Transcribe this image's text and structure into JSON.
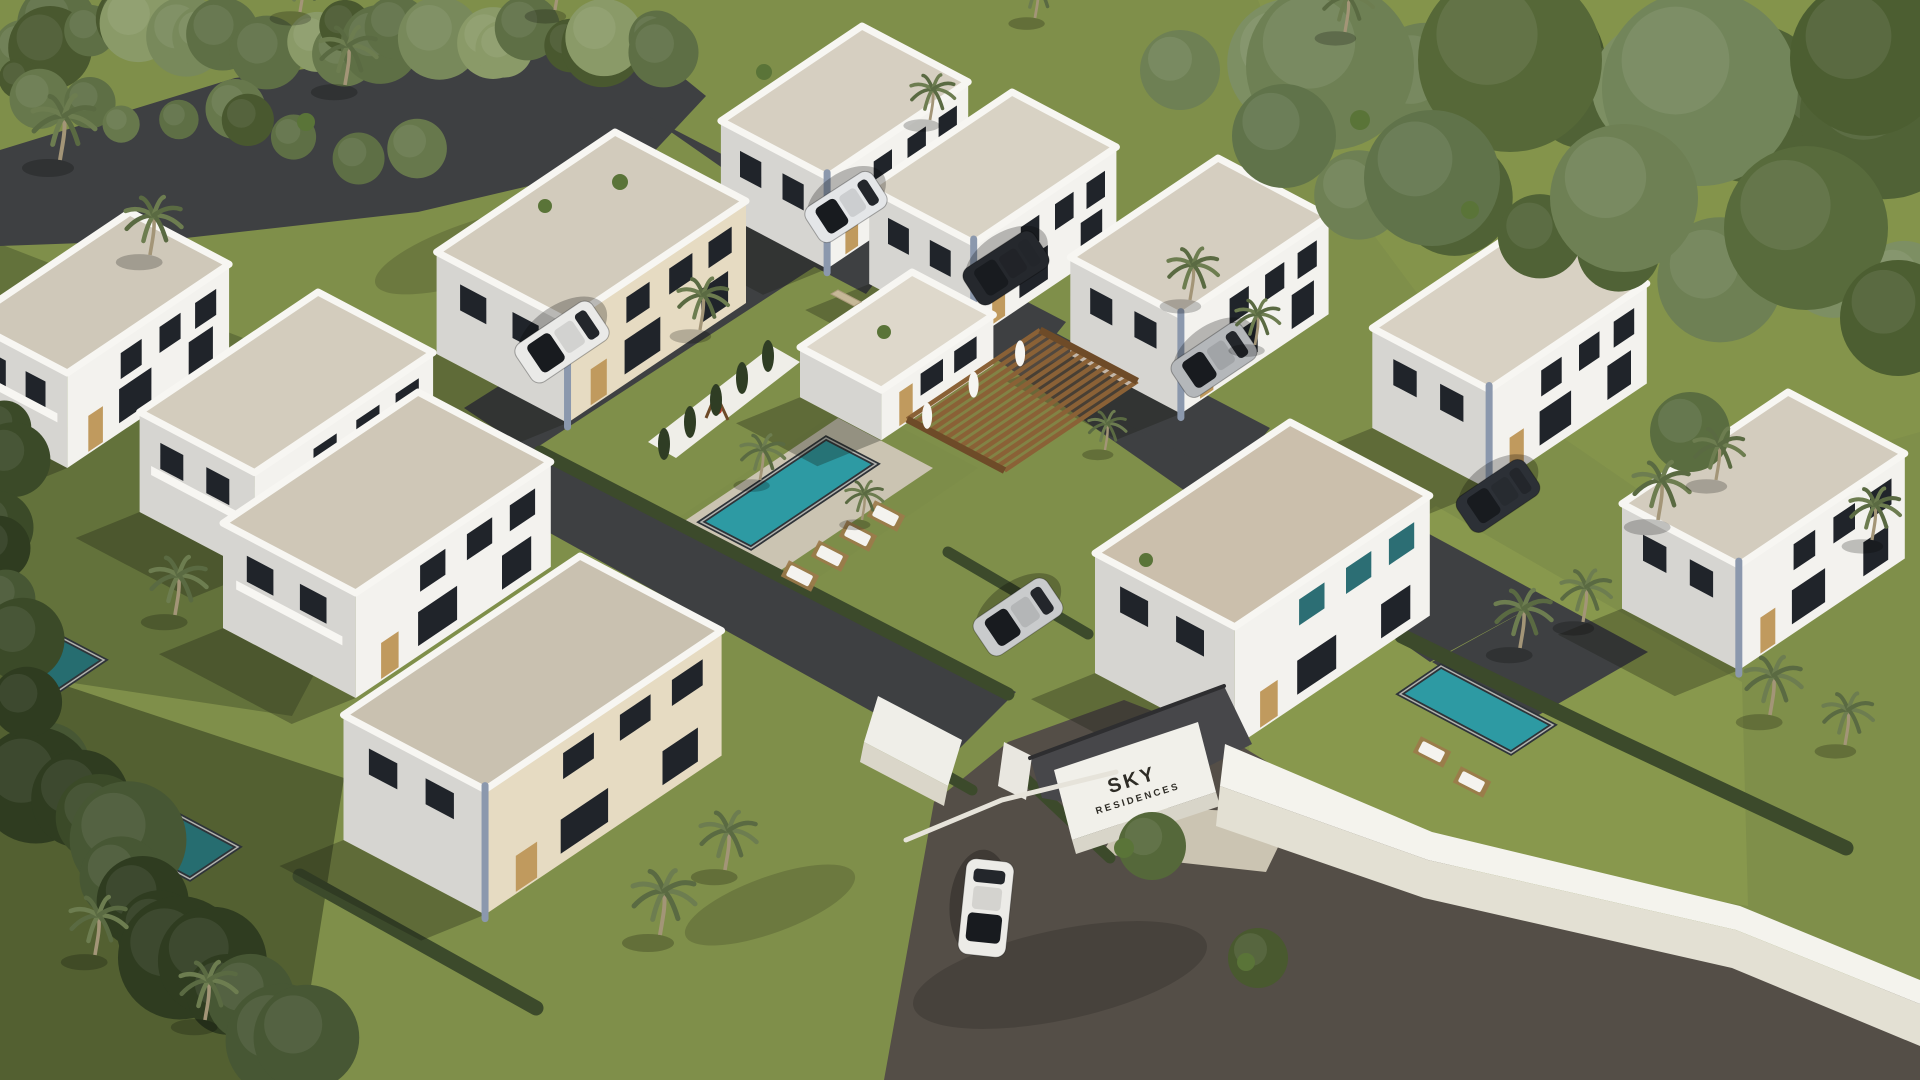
{
  "scene": {
    "title": "Aerial 3D architectural rendering of a gated residential villa community with pools and palm trees",
    "sign": {
      "line1": "SKY",
      "line2": "RESIDENCES"
    },
    "palette": {
      "grass": "#7f8f4a",
      "road": "#3e4042",
      "roadWarm": "#544e47",
      "paver": "#cbc4b2",
      "parapet": "#f7f6f2",
      "wallLit": "#f3f2ee",
      "wallShade": "#d6d5d1",
      "wallBeige": "#e6dbc2",
      "accent": "#8b98ad",
      "window": "#20242a",
      "glass": "#2c6e74",
      "door": "#c09a5e",
      "pool": "#2d9aa3",
      "poolShade": "#266d70",
      "poolEdge": "#2e3338",
      "coping": "#e9e7df",
      "hedge": "#3c4a2b",
      "cypress": "#2f3d24",
      "wood": "#8a6136",
      "woodDark": "#6e4b28",
      "wallWhite": "#efeee8",
      "shadow": "rgba(22,26,16,0.30)",
      "carShadow": "rgba(0,0,0,0.25)",
      "palmFrond": "#6d7d50",
      "palmFrondDark": "#59694271",
      "palmTrunk": "#a39577",
      "lounger": "#f4f3ef",
      "deckWood": "#9c7a4a",
      "canopy": "#47474a",
      "signText": "#2e2c26",
      "stone": "#c6b897"
    },
    "axes": {
      "u": [
        0.885,
        0.466
      ],
      "v": [
        -0.83,
        0.558
      ]
    },
    "ground": {
      "base": "#7f8f4a",
      "polys": [
        {
          "name": "grass-shade-left",
          "points": "0,244 450,418 292,716 0,672",
          "fill": "rgba(30,40,22,0.28)"
        },
        {
          "name": "grass-shade-bottom-left",
          "points": "0,664 344,778 296,1080 0,1080",
          "fill": "rgba(18,26,12,0.40)"
        },
        {
          "name": "grass-sun-villa-j-yard",
          "points": "1236,636 1436,506 1742,682 1748,906 1434,852 1252,772",
          "fill": "rgba(148,163,83,0.45)"
        },
        {
          "name": "grass-sun-top-right",
          "points": "1258,0 1920,0 1920,432 1662,506 1546,426 1422,300 1312,152",
          "fill": "rgba(140,156,78,0.40)"
        },
        {
          "name": "pool-island-lawn",
          "points": "852,402 978,468 800,590 672,522",
          "fill": "#7d8d49"
        },
        {
          "name": "road-top",
          "points": "0,150 235,78 500,44 652,52 706,96 648,158 418,212 168,240 0,246",
          "fill": "road"
        },
        {
          "name": "street-northeast",
          "points": "648,116 772,180 1548,598 1430,662",
          "fill": "road"
        },
        {
          "name": "street-northwest",
          "points": "800,196 868,232 530,452 464,408",
          "fill": "road"
        },
        {
          "name": "street-southwest",
          "points": "520,436 1016,692 952,756 458,482",
          "fill": "road"
        },
        {
          "name": "driveway-a",
          "points": "762,164 908,240 866,294 722,218",
          "fill": "road"
        },
        {
          "name": "driveway-b",
          "points": "920,246 1066,322 1024,374 880,298",
          "fill": "road"
        },
        {
          "name": "driveway-c",
          "points": "1128,354 1270,428 1230,478 1088,404",
          "fill": "road"
        },
        {
          "name": "street-east-end",
          "points": "1432,662 1548,598 1648,652 1530,720",
          "fill": "road"
        },
        {
          "name": "road-bottom-lot",
          "points": "884,1080 934,802 1008,742 1124,700 1238,744 1424,858 1704,932 1920,1000 1920,1080",
          "fill": "roadWarm"
        },
        {
          "name": "pool-deck",
          "points": "838,418 933,468 775,574 680,524",
          "fill": "paver"
        },
        {
          "name": "walkway-entrance",
          "points": "1130,806 1294,814 1266,872 1102,854",
          "fill": "paver"
        },
        {
          "name": "pool-privacy-wall",
          "points": "772,346 800,362 676,458 648,442",
          "fill": "wallWhite"
        }
      ]
    },
    "strokes": [
      {
        "name": "hedge-pool-island",
        "points": "540,452 1008,694",
        "stroke": "hedge",
        "width": 13
      },
      {
        "name": "hedge-villa-j",
        "points": "948,552 1088,634",
        "stroke": "hedge",
        "width": 11
      },
      {
        "name": "hedge-east-pool",
        "points": "1402,636 1612,738 1846,848",
        "stroke": "hedge",
        "width": 15
      },
      {
        "name": "hedge-entry-street",
        "points": "1010,764 1110,858",
        "stroke": "hedge",
        "width": 11
      },
      {
        "name": "hedge-foreground",
        "points": "300,876 536,1008",
        "stroke": "hedge",
        "width": 15
      },
      {
        "name": "hedge-gate-left",
        "points": "884,740 972,790",
        "stroke": "hedge",
        "width": 11
      }
    ],
    "roadShadows": [
      {
        "x": 1060,
        "y": 975,
        "rx": 150,
        "ry": 45,
        "rot": -12
      },
      {
        "x": 770,
        "y": 905,
        "rx": 90,
        "ry": 28,
        "rot": -20
      },
      {
        "x": 480,
        "y": 250,
        "rx": 110,
        "ry": 30,
        "rot": -18
      }
    ],
    "pools": [
      {
        "name": "community-pool",
        "points": "826,438 876,464 751,548 701,522",
        "fill": "pool"
      },
      {
        "name": "villa-pool-east",
        "points": "1441,666 1553,725 1511,753 1400,694",
        "fill": "pool"
      },
      {
        "name": "villa-pool-west-1",
        "points": "20,616 104,660 58,691 -26,647",
        "fill": "poolShade"
      },
      {
        "name": "villa-pool-west-2",
        "points": "150,800 238,847 190,879 102,832",
        "fill": "poolShade"
      }
    ],
    "houses": [
      {
        "name": "villa-a",
        "px": 862,
        "py": 26,
        "w": 120,
        "d": 170,
        "h": 92,
        "roof": "#d6cfc1",
        "acc": true
      },
      {
        "name": "villa-b",
        "px": 1012,
        "py": 92,
        "w": 118,
        "d": 172,
        "h": 96,
        "roof": "#d8d2c4",
        "acc": true
      },
      {
        "name": "villa-f",
        "px": 615,
        "py": 132,
        "w": 148,
        "d": 215,
        "h": 102,
        "roof": "#d2cbbc",
        "acc": true,
        "beigeR": true
      },
      {
        "name": "villa-c",
        "px": 1218,
        "py": 158,
        "w": 125,
        "d": 178,
        "h": 98,
        "roof": "#d5cec0",
        "acc": true
      },
      {
        "name": "villa-g",
        "px": 130,
        "py": 212,
        "w": 112,
        "d": 195,
        "h": 95,
        "roof": "#cfc8b9",
        "bal": true
      },
      {
        "name": "villa-d",
        "px": 1530,
        "py": 222,
        "w": 132,
        "d": 190,
        "h": 100,
        "roof": "#d8d1c3",
        "acc": true
      },
      {
        "name": "clubhouse",
        "px": 912,
        "py": 272,
        "w": 92,
        "d": 135,
        "h": 50,
        "roof": "#ded8cb",
        "club": true
      },
      {
        "name": "villa-h",
        "px": 318,
        "py": 292,
        "w": 130,
        "d": 215,
        "h": 100,
        "roof": "#d3ccbd",
        "bal": true
      },
      {
        "name": "villa-e",
        "px": 1788,
        "py": 392,
        "w": 132,
        "d": 200,
        "h": 105,
        "roof": "#d3ccbe",
        "acc": true
      },
      {
        "name": "villa-i1",
        "px": 418,
        "py": 392,
        "w": 150,
        "d": 235,
        "h": 105,
        "roof": "#cfc7b7",
        "bal": true
      },
      {
        "name": "villa-j",
        "px": 1290,
        "py": 422,
        "w": 158,
        "d": 235,
        "h": 120,
        "roof": "#cbbfac",
        "glass": true
      },
      {
        "name": "villa-i2",
        "px": 580,
        "py": 556,
        "w": 160,
        "d": 285,
        "h": 125,
        "roof": "#c9c1b0",
        "acc": true,
        "beigeR": true
      }
    ],
    "windowSpec": {
      "upperY": 16,
      "upperH": 26,
      "lowerH": 34,
      "rowsR": [
        [
          0.08,
          0.13
        ],
        [
          0.3,
          0.13
        ],
        [
          0.54,
          0.13
        ]
      ],
      "lowerR": [
        [
          0.1,
          0.15
        ],
        [
          0.48,
          0.2
        ]
      ],
      "door": [
        0.78,
        0.09
      ],
      "rowsL": [
        [
          0.18,
          0.2
        ],
        [
          0.58,
          0.2
        ]
      ]
    },
    "pergola": {
      "px": 1040,
      "py": 330,
      "w": 110,
      "d": 160,
      "slats": 13
    },
    "stoneSign": {
      "points": "838,290 861,302 854,306 831,294"
    },
    "playground": {
      "x": 716,
      "y": 408
    },
    "cypresses": [
      {
        "x": 768,
        "y": 356
      },
      {
        "x": 742,
        "y": 378
      },
      {
        "x": 716,
        "y": 400
      },
      {
        "x": 690,
        "y": 422
      },
      {
        "x": 664,
        "y": 444
      }
    ],
    "loungers": [
      {
        "x": 886,
        "y": 516,
        "rot": 27
      },
      {
        "x": 858,
        "y": 536,
        "rot": 27
      },
      {
        "x": 830,
        "y": 556,
        "rot": 27
      },
      {
        "x": 800,
        "y": 576,
        "rot": 27
      },
      {
        "x": 1432,
        "y": 752,
        "rot": 27
      },
      {
        "x": 1472,
        "y": 782,
        "rot": 27
      }
    ],
    "cars": [
      {
        "name": "car-white-entry",
        "x": 986,
        "y": 908,
        "rot": 96,
        "len": 96,
        "wid": 48,
        "color": "#ecebe7"
      },
      {
        "name": "suv-white-west",
        "x": 562,
        "y": 342,
        "rot": 146,
        "len": 92,
        "wid": 46,
        "color": "#eaeae8"
      },
      {
        "name": "car-white-north",
        "x": 846,
        "y": 207,
        "rot": 147,
        "len": 80,
        "wid": 42,
        "color": "#e4e6e8"
      },
      {
        "name": "suv-black-north",
        "x": 1006,
        "y": 268,
        "rot": 147,
        "len": 84,
        "wid": 43,
        "color": "#25282d"
      },
      {
        "name": "car-silver-north",
        "x": 1214,
        "y": 360,
        "rot": 146,
        "len": 84,
        "wid": 43,
        "color": "#b4b7ba"
      },
      {
        "name": "car-silver-center",
        "x": 1018,
        "y": 617,
        "rot": 146,
        "len": 88,
        "wid": 44,
        "color": "#c9cbcc"
      },
      {
        "name": "car-dark-east",
        "x": 1498,
        "y": 496,
        "rot": 146,
        "len": 82,
        "wid": 42,
        "color": "#2c3036"
      }
    ],
    "treeStrips": [
      {
        "x1": 10,
        "y1": 34,
        "x2": 680,
        "y2": 44,
        "n": 24,
        "rmin": 22,
        "rmax": 42,
        "k": 1,
        "colors": [
          "#5e6f45",
          "#78895b",
          "#49582f",
          "#8a9a68",
          "#67784c"
        ]
      },
      {
        "x1": 0,
        "y1": 86,
        "x2": 400,
        "y2": 150,
        "n": 10,
        "rmin": 18,
        "rmax": 32,
        "k": 2,
        "colors": [
          "#5e6f45",
          "#49582f",
          "#67784c"
        ]
      },
      {
        "x1": 1290,
        "y1": 60,
        "x2": 1900,
        "y2": 110,
        "n": 9,
        "rmin": 48,
        "rmax": 85,
        "k": 3,
        "colors": [
          "#6e8054",
          "#506236",
          "#7d8f63",
          "#44552c"
        ]
      },
      {
        "x1": 1380,
        "y1": 190,
        "x2": 1900,
        "y2": 300,
        "n": 7,
        "rmin": 40,
        "rmax": 72,
        "k": 4,
        "colors": [
          "#6e8054",
          "#506236",
          "#7d8f63"
        ]
      },
      {
        "x1": 30,
        "y1": 770,
        "x2": 300,
        "y2": 1050,
        "n": 14,
        "rmin": 34,
        "rmax": 62,
        "k": 5,
        "colors": [
          "#3b4a28",
          "#2f3c20",
          "#475734",
          "#26311a"
        ]
      },
      {
        "x1": 6,
        "y1": 420,
        "x2": 34,
        "y2": 700,
        "n": 7,
        "rmin": 26,
        "rmax": 44,
        "k": 6,
        "colors": [
          "#3b4a28",
          "#475734",
          "#2f3c20"
        ]
      }
    ],
    "trees": [
      {
        "x": 1330,
        "y": 66,
        "r": 84,
        "c": "#6e8054"
      },
      {
        "x": 1510,
        "y": 60,
        "r": 92,
        "c": "#566838"
      },
      {
        "x": 1700,
        "y": 88,
        "r": 98,
        "c": "#72855a"
      },
      {
        "x": 1868,
        "y": 58,
        "r": 78,
        "c": "#4c5e31"
      },
      {
        "x": 1432,
        "y": 178,
        "r": 68,
        "c": "#60734a"
      },
      {
        "x": 1624,
        "y": 198,
        "r": 74,
        "c": "#6e8054"
      },
      {
        "x": 1806,
        "y": 228,
        "r": 82,
        "c": "#586b3c"
      },
      {
        "x": 1898,
        "y": 318,
        "r": 58,
        "c": "#4c5e31"
      },
      {
        "x": 1284,
        "y": 136,
        "r": 52,
        "c": "#60734a"
      },
      {
        "x": 1180,
        "y": 70,
        "r": 40,
        "c": "#6e8054"
      },
      {
        "x": 1152,
        "y": 846,
        "r": 34,
        "c": "#55683a"
      },
      {
        "x": 1258,
        "y": 958,
        "r": 30,
        "c": "#49592f"
      },
      {
        "x": 1690,
        "y": 432,
        "r": 40,
        "c": "#5a6d40"
      }
    ],
    "bushes": [
      {
        "x": 620,
        "y": 182,
        "r": 8
      },
      {
        "x": 545,
        "y": 206,
        "r": 7
      },
      {
        "x": 306,
        "y": 122,
        "r": 9
      },
      {
        "x": 764,
        "y": 72,
        "r": 8
      },
      {
        "x": 1124,
        "y": 848,
        "r": 10
      },
      {
        "x": 1246,
        "y": 962,
        "r": 9
      },
      {
        "x": 884,
        "y": 332,
        "r": 7
      },
      {
        "x": 1360,
        "y": 120,
        "r": 10
      },
      {
        "x": 1470,
        "y": 210,
        "r": 9
      },
      {
        "x": 1146,
        "y": 560,
        "r": 7
      }
    ],
    "palms": [
      {
        "x": 60,
        "y": 160,
        "s": 1.0
      },
      {
        "x": 150,
        "y": 255,
        "s": 0.9
      },
      {
        "x": 345,
        "y": 85,
        "s": 0.9
      },
      {
        "x": 300,
        "y": 12,
        "s": 0.8
      },
      {
        "x": 555,
        "y": 10,
        "s": 0.8
      },
      {
        "x": 930,
        "y": 120,
        "s": 0.7
      },
      {
        "x": 1035,
        "y": 18,
        "s": 0.7
      },
      {
        "x": 1345,
        "y": 32,
        "s": 0.8
      },
      {
        "x": 700,
        "y": 330,
        "s": 0.8
      },
      {
        "x": 760,
        "y": 480,
        "s": 0.7
      },
      {
        "x": 862,
        "y": 520,
        "s": 0.6
      },
      {
        "x": 1190,
        "y": 300,
        "s": 0.8
      },
      {
        "x": 1255,
        "y": 345,
        "s": 0.7
      },
      {
        "x": 1105,
        "y": 450,
        "s": 0.6
      },
      {
        "x": 1520,
        "y": 648,
        "s": 0.9
      },
      {
        "x": 1583,
        "y": 622,
        "s": 0.8
      },
      {
        "x": 1658,
        "y": 520,
        "s": 0.9
      },
      {
        "x": 1716,
        "y": 480,
        "s": 0.8
      },
      {
        "x": 1770,
        "y": 715,
        "s": 0.9
      },
      {
        "x": 1845,
        "y": 745,
        "s": 0.8
      },
      {
        "x": 1872,
        "y": 540,
        "s": 0.8
      },
      {
        "x": 175,
        "y": 615,
        "s": 0.9
      },
      {
        "x": 660,
        "y": 935,
        "s": 1.0
      },
      {
        "x": 725,
        "y": 870,
        "s": 0.9
      },
      {
        "x": 95,
        "y": 955,
        "s": 0.9
      },
      {
        "x": 205,
        "y": 1020,
        "s": 0.9
      }
    ],
    "entrance": {
      "polys": [
        {
          "name": "entry-wall-left",
          "points": "878,696 962,740 948,786 864,742",
          "fill": "wallWhite"
        },
        {
          "name": "entry-wall-left-face",
          "points": "864,742 948,786 944,806 860,762",
          "fill": "#dad6c9"
        },
        {
          "name": "entry-canopy",
          "points": "1030,758 1224,686 1252,744 1120,812 1042,798",
          "fill": "canopy"
        },
        {
          "name": "entry-sign-wall",
          "points": "1054,770 1198,722 1216,792 1072,840",
          "fill": "#f1f0ea"
        },
        {
          "name": "entry-sign-wall-shade",
          "points": "1072,840 1216,792 1220,806 1076,854",
          "fill": "#d8d5c9"
        },
        {
          "name": "entry-pillar",
          "points": "1004,742 1032,756 1026,800 998,786",
          "fill": "#e9e7e0"
        },
        {
          "name": "perimeter-wall-top",
          "points": "1225,744 1432,832 1740,906 1920,980 1920,1004 1736,930 1428,860 1220,786",
          "fill": "#f4f3ed"
        },
        {
          "name": "perimeter-wall-face",
          "points": "1220,786 1428,860 1736,930 1920,1004 1920,1046 1732,968 1424,898 1216,826",
          "fill": "#e3e0d3"
        }
      ],
      "strokes": [
        {
          "name": "entry-canopy-edge",
          "points": "1030,758 1224,686",
          "stroke": "#2e2e30",
          "width": 4
        },
        {
          "name": "entry-curb",
          "points": "906,840 1002,800 1116,772",
          "stroke": "#e6e3da",
          "width": 5
        }
      ]
    }
  }
}
